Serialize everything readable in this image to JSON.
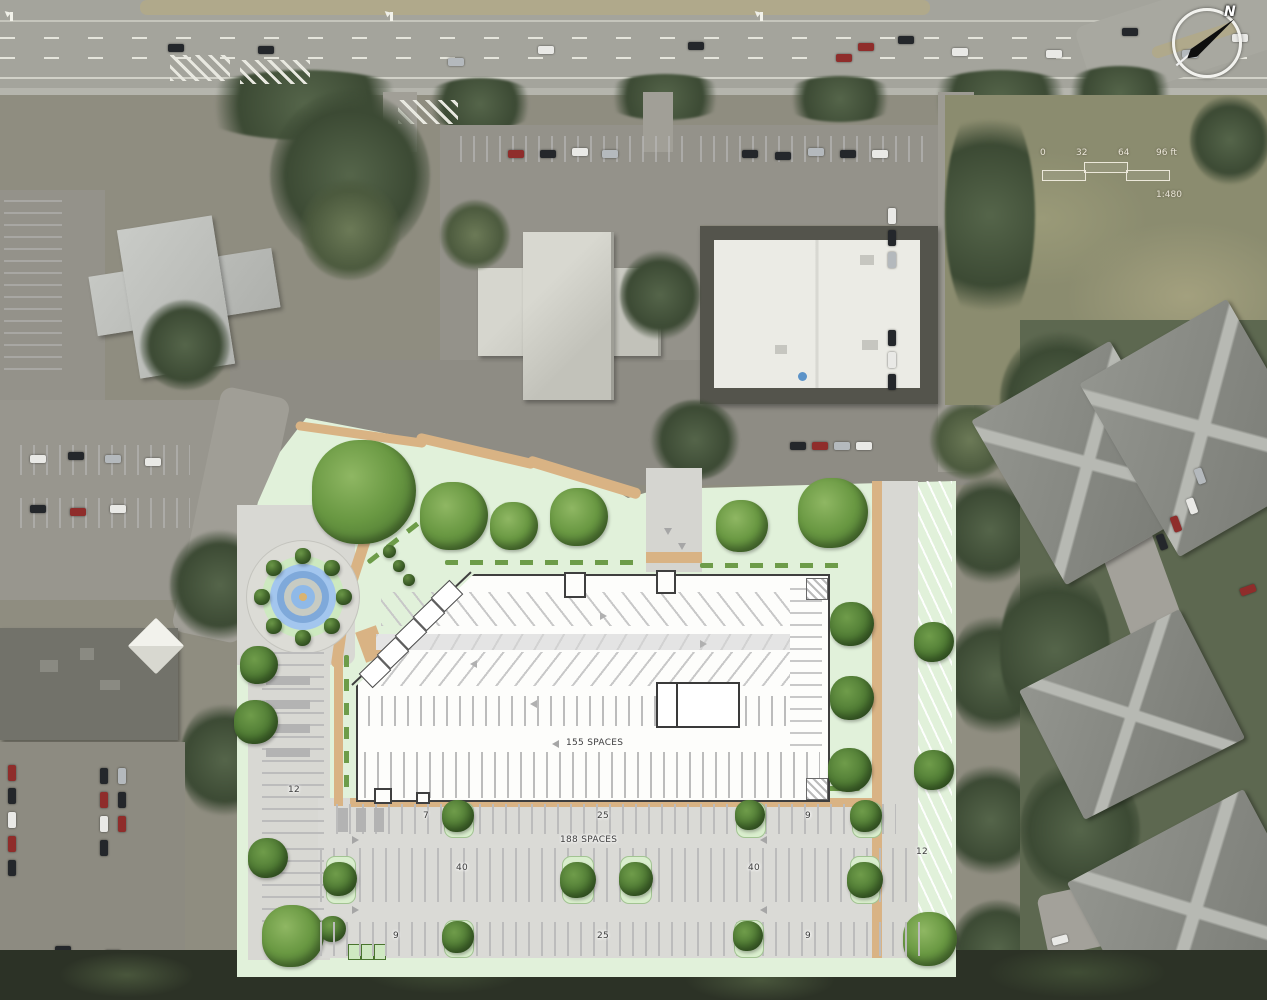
{
  "plan": {
    "building_spaces_label": "155 SPACES",
    "surface_lot_spaces_label": "188 SPACES",
    "stall_counts": {
      "west_strip": "12",
      "east_strip": "12",
      "row_north_left": "7",
      "row_north_center": "25",
      "row_north_right": "9",
      "row_middle_left": "40",
      "row_middle_right": "40",
      "row_south_left": "9",
      "row_south_center": "25",
      "row_south_right": "9"
    }
  },
  "scale_bar": {
    "ticks": [
      "0",
      "32",
      "64",
      "96 ft"
    ],
    "ratio": "1:480"
  },
  "north_arrow": {
    "label": "N"
  },
  "colors": {
    "plan_green": "#e1f1da",
    "walkway_tan": "#d9b384",
    "fountain_blue": "#8fb9e8",
    "tree_green": "#4e7a33",
    "pavement_gray": "#d9d9d4",
    "building_fill": "#fdfdfb",
    "building_outline": "#3f3f3f"
  }
}
